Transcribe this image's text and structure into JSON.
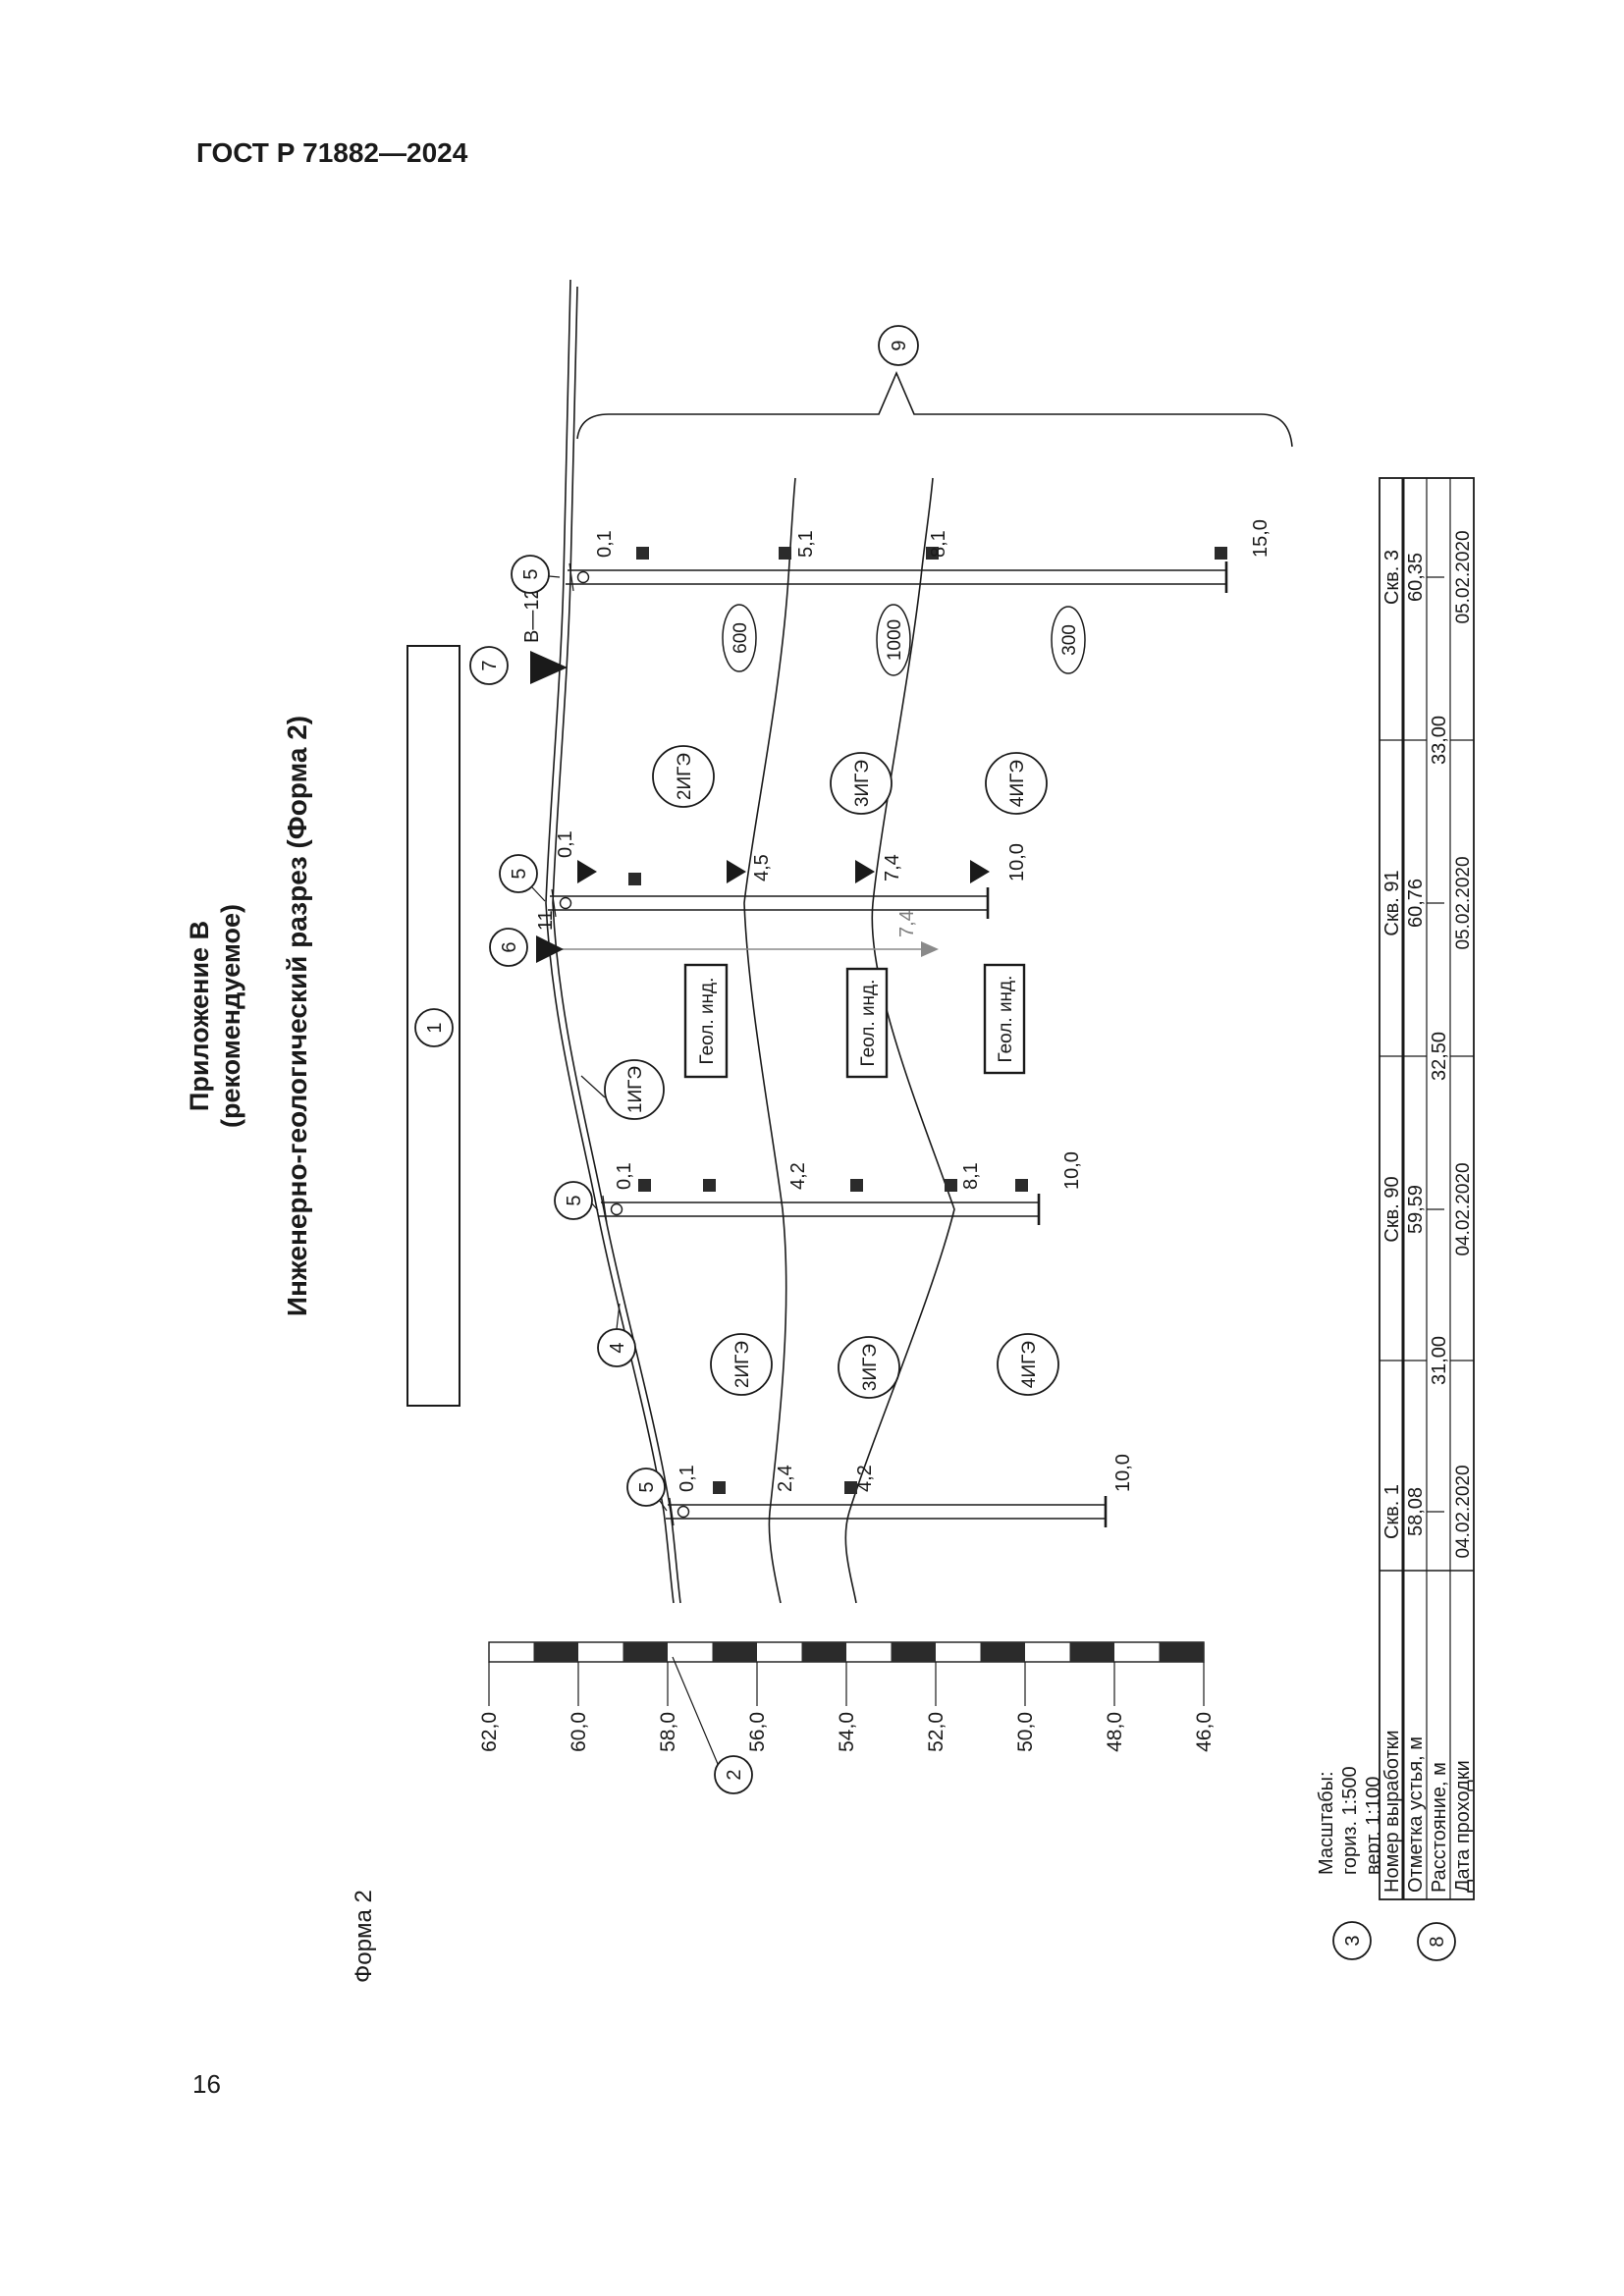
{
  "page": {
    "header": "ГОСТ Р 71882—2024",
    "number": "16"
  },
  "titles": {
    "line1": "Приложение В",
    "line2": "(рекомендуемое)",
    "line3": "Инженерно-геологический разрез (Форма 2)",
    "form_label": "Форма 2"
  },
  "scales": {
    "title": "Масштабы:",
    "horizontal": "гориз. 1:500",
    "vertical": "верт. 1:100"
  },
  "elevation_scale": {
    "labels": [
      "62,0",
      "60,0",
      "58,0",
      "56,0",
      "54,0",
      "52,0",
      "50,0",
      "48,0",
      "46,0"
    ]
  },
  "callouts": {
    "c1": "1",
    "c2": "2",
    "c3": "3",
    "c4": "4",
    "c5": "5",
    "c6": "6",
    "c7": "7",
    "c8": "8",
    "c9": "9"
  },
  "section_marker": {
    "label": "В—12"
  },
  "projected_borehole": {
    "number": "11",
    "depth": "7,4"
  },
  "geo_index_box": "Геол. инд.",
  "ige": {
    "surface": "1ИГЭ",
    "upper": [
      "2ИГЭ",
      "3ИГЭ",
      "4ИГЭ"
    ],
    "lower": [
      "2ИГЭ",
      "3ИГЭ",
      "4ИГЭ"
    ]
  },
  "ellipse_values": [
    "600",
    "1000",
    "300"
  ],
  "boreholes": [
    {
      "name": "Скв. 1",
      "elevation": "58,08",
      "date": "04.02.2020",
      "depth_labels": [
        "0,1",
        "2,4",
        "4,2",
        "10,0"
      ]
    },
    {
      "name": "Скв. 90",
      "elevation": "59,59",
      "date": "04.02.2020",
      "depth_labels": [
        "0,1",
        "4,2",
        "8,1",
        "10,0"
      ]
    },
    {
      "name": "Скв. 91",
      "elevation": "60,76",
      "date": "05.02.2020",
      "depth_labels": [
        "0,1",
        "4,5",
        "7,4",
        "10,0"
      ]
    },
    {
      "name": "Скв. 3",
      "elevation": "60,35",
      "date": "05.02.2020",
      "depth_labels": [
        "0,1",
        "5,1",
        "8,1",
        "15,0"
      ]
    }
  ],
  "distances": [
    "31,00",
    "32,50",
    "33,00"
  ],
  "table": {
    "row_headers": [
      "Номер выработки",
      "Отметка устья, м",
      "Расстояние, м",
      "Дата проходки"
    ]
  },
  "colors": {
    "line": "#1a1a1a",
    "muted": "#8a8a8a"
  }
}
